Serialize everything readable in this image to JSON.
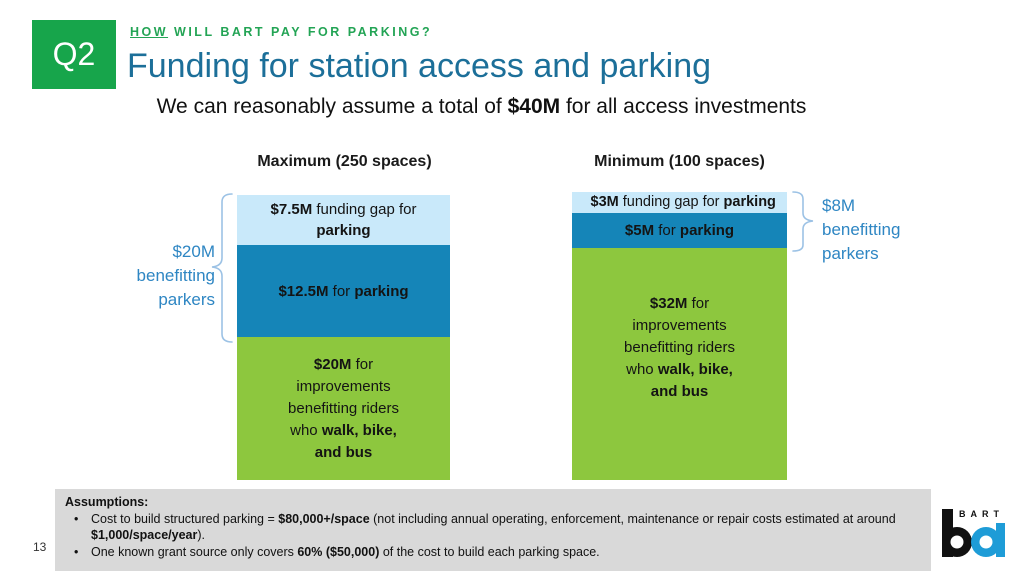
{
  "slide": {
    "q2_label": "Q2",
    "kicker_parts": [
      {
        "t": "HOW",
        "b": true,
        "u": true
      },
      {
        "t": " WILL BART PAY FOR PARKING?"
      }
    ],
    "title": "Funding for station access and parking",
    "subtitle_parts": [
      {
        "t": "We can reasonably assume a total of "
      },
      {
        "t": "$40M",
        "b": true
      },
      {
        "t": " for all access investments"
      }
    ],
    "page_number": "13"
  },
  "chart_data": {
    "type": "bar",
    "subtype": "stacked-vertical",
    "units": "$M",
    "total_per_bar": 40,
    "categories": [
      "Maximum (250 spaces)",
      "Minimum (100 spaces)"
    ],
    "series": [
      {
        "name": "Funding gap for parking",
        "values": [
          7.5,
          3
        ],
        "color": "#C9E9FA"
      },
      {
        "name": "For parking",
        "values": [
          12.5,
          5
        ],
        "color": "#1585B8"
      },
      {
        "name": "For improvements benefitting riders who walk, bike, and bus",
        "values": [
          20,
          32
        ],
        "color": "#8DC73E"
      }
    ],
    "annotations": [
      {
        "text": "$20M benefitting parkers",
        "bar": "Maximum (250 spaces)",
        "covers_series": [
          "Funding gap for parking",
          "For parking"
        ]
      },
      {
        "text": "$8M benefitting parkers",
        "bar": "Minimum (100 spaces)",
        "covers_series": [
          "Funding gap for parking",
          "For parking"
        ]
      }
    ],
    "legend_position": "none",
    "grid": false
  },
  "bars": {
    "left": {
      "header": "Maximum (250 spaces)",
      "segments": {
        "gap": [
          {
            "t": "$7.5M",
            "b": true
          },
          {
            "t": " funding gap for"
          },
          {
            "br": true
          },
          {
            "t": "parking",
            "b": true
          }
        ],
        "parking": [
          {
            "t": "$12.5M",
            "b": true
          },
          {
            "t": " for "
          },
          {
            "t": "parking",
            "b": true
          }
        ],
        "improvements": [
          {
            "t": "$20M",
            "b": true
          },
          {
            "t": " for"
          },
          {
            "br": true
          },
          {
            "t": "improvements"
          },
          {
            "br": true
          },
          {
            "t": "benefitting riders"
          },
          {
            "br": true
          },
          {
            "t": "who "
          },
          {
            "t": "walk, bike,",
            "b": true
          },
          {
            "br": true
          },
          {
            "t": "and bus",
            "b": true
          }
        ]
      },
      "bracket_label": "$20M benefitting parkers"
    },
    "right": {
      "header": "Minimum (100 spaces)",
      "segments": {
        "gap": [
          {
            "t": "$3M",
            "b": true
          },
          {
            "t": " funding gap for "
          },
          {
            "t": "parking",
            "b": true
          }
        ],
        "parking": [
          {
            "t": "$5M",
            "b": true
          },
          {
            "t": " for "
          },
          {
            "t": "parking",
            "b": true
          }
        ],
        "improvements": [
          {
            "t": "$32M",
            "b": true
          },
          {
            "t": " for"
          },
          {
            "br": true
          },
          {
            "t": "improvements"
          },
          {
            "br": true
          },
          {
            "t": "benefitting riders"
          },
          {
            "br": true
          },
          {
            "t": "who "
          },
          {
            "t": "walk, bike,",
            "b": true
          },
          {
            "br": true
          },
          {
            "t": "and bus",
            "b": true
          }
        ]
      },
      "bracket_label": "$8M benefitting parkers"
    }
  },
  "assumptions": {
    "heading": "Assumptions:",
    "bullet_glyph": "•",
    "bullets": [
      [
        {
          "t": "Cost to build structured parking = "
        },
        {
          "t": "$80,000+/space",
          "b": true
        },
        {
          "t": " (not including annual operating, enforcement, maintenance or repair costs estimated at around "
        },
        {
          "t": "$1,000/space/year",
          "b": true
        },
        {
          "t": ")."
        }
      ],
      [
        {
          "t": "One known grant source only covers "
        },
        {
          "t": "60% ($50,000)",
          "b": true
        },
        {
          "t": " of the cost to build each parking space."
        }
      ]
    ]
  },
  "logo": {
    "letters": "BART"
  },
  "colors": {
    "q2_green": "#17A54B",
    "kicker_green": "#23A455",
    "title_blue": "#1C6F99",
    "segment_light_blue": "#C9E9FA",
    "segment_dark_blue": "#1585B8",
    "segment_green": "#8DC73E",
    "annotation_blue": "#2E86C3",
    "bracket_blue": "#9CC2E5",
    "footer_gray": "#D9D9D9",
    "logo_blue": "#1E9CD7",
    "logo_black": "#111111"
  }
}
